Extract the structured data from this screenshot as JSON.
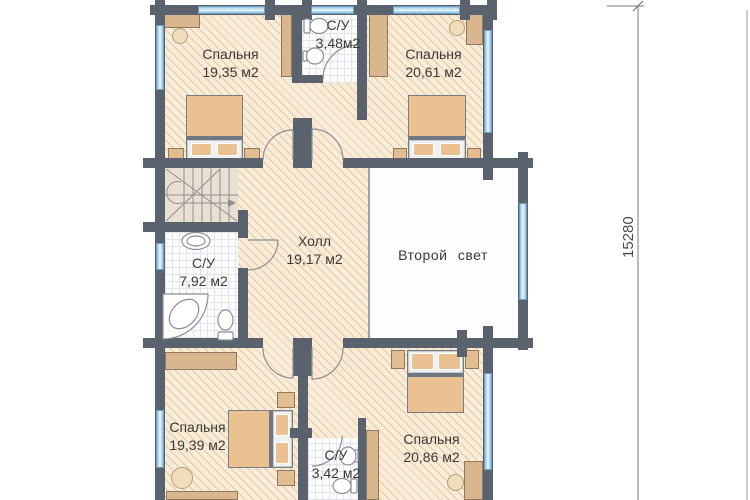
{
  "plan": {
    "type": "floor-plan",
    "rooms": [
      {
        "id": "bedroom-top-left",
        "name": "Спальня",
        "area": "19,35 м2"
      },
      {
        "id": "bathroom-top",
        "name": "С/У",
        "area": "3,48м2"
      },
      {
        "id": "bedroom-top-right",
        "name": "Спальня",
        "area": "20,61 м2"
      },
      {
        "id": "hall",
        "name": "Холл",
        "area": "19,17 м2"
      },
      {
        "id": "bathroom-left",
        "name": "С/У",
        "area": "7,92 м2"
      },
      {
        "id": "second-light-void",
        "name": "Второй свет",
        "area": ""
      },
      {
        "id": "bedroom-bottom-left",
        "name": "Спальня",
        "area": "19,39 м2"
      },
      {
        "id": "bathroom-bottom",
        "name": "С/У",
        "area": "3,42 м2"
      },
      {
        "id": "bedroom-bottom-right",
        "name": "Спальня",
        "area": "20,86 м2"
      }
    ],
    "dimensions": {
      "total_height_mm": "15280"
    },
    "colors": {
      "wall": "#5a626d",
      "floor_hatch": "#f9ecd8",
      "window_glass": "#ddeffb",
      "window_frame": "#6d9cbd",
      "furniture": "#d9b68e",
      "bed": "#ecc191",
      "tile": "#fdfdfe"
    }
  }
}
